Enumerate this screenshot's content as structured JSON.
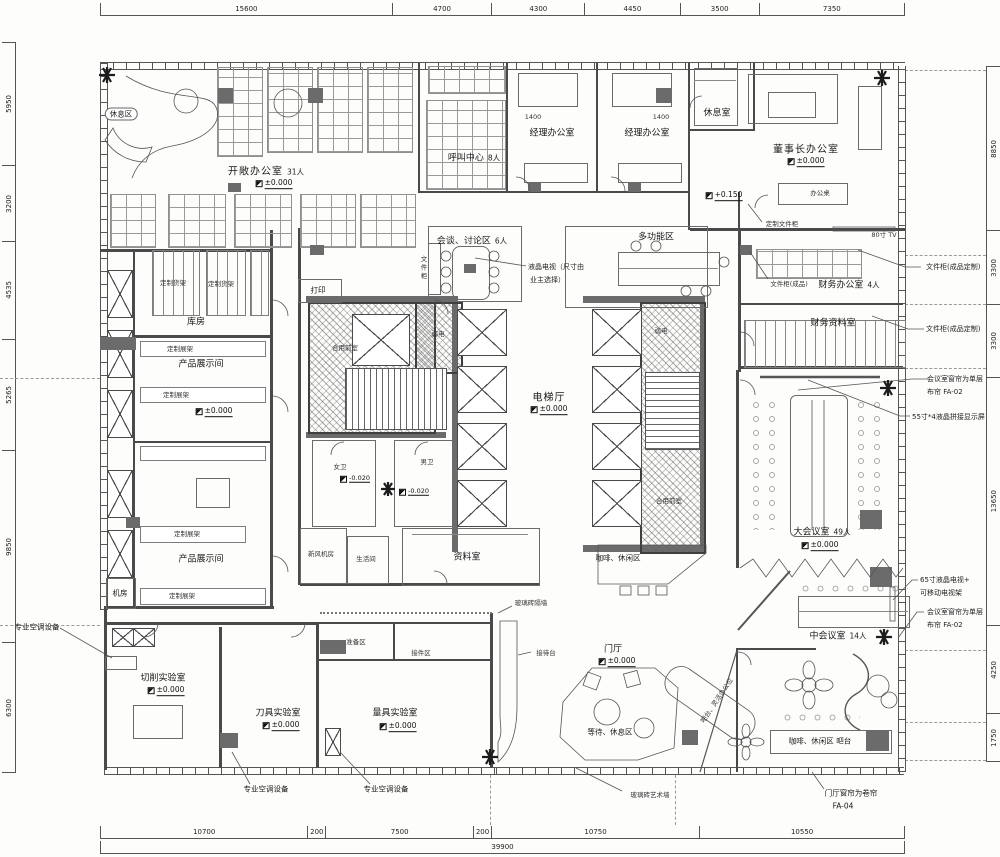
{
  "rooms": {
    "rest_area": {
      "label": "休息区"
    },
    "open_office": {
      "label": "开敞办公室",
      "capacity": "31人"
    },
    "call_center": {
      "label": "呼叫中心",
      "capacity": "8人"
    },
    "manager_office_1": {
      "label": "经理办公室"
    },
    "manager_office_2": {
      "label": "经理办公室"
    },
    "lounge": {
      "label": "休息室"
    },
    "chairman_office": {
      "label": "董事长办公室"
    },
    "finance_office": {
      "label": "财务办公室",
      "capacity": "4人"
    },
    "finance_archive": {
      "label": "财务资料室"
    },
    "discussion_area": {
      "label": "会谈、讨论区",
      "capacity": "6人"
    },
    "multi_function": {
      "label": "多功能区"
    },
    "print_nook": {
      "label": "打印"
    },
    "shared_front_room": {
      "label": "合用前室"
    },
    "weak_electric": {
      "label": "弱电"
    },
    "elevator_hall": {
      "label": "电梯厅"
    },
    "storage": {
      "label": "库房"
    },
    "showroom": {
      "label": "产品展示间"
    },
    "machine_room": {
      "label": "机房"
    },
    "women_wc": {
      "label": "女卫"
    },
    "men_wc": {
      "label": "男卫"
    },
    "fresh_air_room": {
      "label": "新风机房"
    },
    "pantry": {
      "label": "生活间"
    },
    "archive": {
      "label": "资料室"
    },
    "coffee_lounge": {
      "label": "咖啡、休闲区"
    },
    "big_meeting": {
      "label": "大会议室",
      "capacity": "49人"
    },
    "mid_meeting": {
      "label": "中会议室",
      "capacity": "14人"
    },
    "coffee_bar": {
      "label": "咖啡、休闲区 吧台"
    },
    "cutting_lab": {
      "label": "切削实验室"
    },
    "tool_lab": {
      "label": "刀具实验室"
    },
    "measure_lab": {
      "label": "量具实验室"
    },
    "prep_area": {
      "label": "准备区"
    },
    "receiving_area": {
      "label": "接件区"
    },
    "entrance_hall": {
      "label": "门厅"
    },
    "waiting_area": {
      "label": "等待、休息区"
    },
    "bar_flex_seats": {
      "label": "吧台、灵活办公位"
    }
  },
  "furniture": {
    "custom_shelf": "定制货架",
    "custom_rack": "定制展架",
    "file_cabinet_finished": "文件柜(成品)",
    "file_cabinet_custom": "文件柜(成品定制)",
    "custom_file_cabinet": "定制文件柜",
    "office_desk": "办公桌",
    "file_cabinet": "文件柜",
    "tv_80": "80寸 TV",
    "reception_desk": "接待台"
  },
  "annotations": {
    "lcd_tv_line1": "液晶电视（尺寸由",
    "lcd_tv_line2": "业主选择）",
    "meeting_curtain_line1": "会议室窗帘为单层",
    "meeting_curtain_line2": "布帘 FA-02",
    "lcd_splice_screen": "55寸*4液晶拼接显示屏",
    "tv_65_line1": "65寸液晶电视+",
    "tv_65_line2": "可移动电视架",
    "pro_ac_equipment": "专业空调设备",
    "glass_brick_partition": "玻璃砖隔墙",
    "glass_brick_art_wall": "玻璃砖艺术墙",
    "hall_curtain_line1": "门厅窗帘为卷帘",
    "hall_curtain_line2": "FA-04"
  },
  "elevations": {
    "zero": "±0.000",
    "plus_150": "+0.150",
    "minus_020": "-0.020"
  },
  "dimensions": {
    "top": [
      "15600",
      "4700",
      "4300",
      "4450",
      "3500",
      "7350"
    ],
    "bottom": [
      "10700",
      "200",
      "7500",
      "200",
      "10750",
      "10550"
    ],
    "bottom_total": "39900",
    "left": [
      "5950",
      "3200",
      "4535",
      "5265",
      "9850",
      "6300"
    ],
    "right": [
      "8850",
      "3300",
      "3300",
      "13650",
      "4250",
      "1750"
    ],
    "manager_desk": "1400"
  },
  "colors": {
    "wall": "#4a4a4a",
    "paper": "#fdfdfc",
    "hatch": "#646464"
  }
}
